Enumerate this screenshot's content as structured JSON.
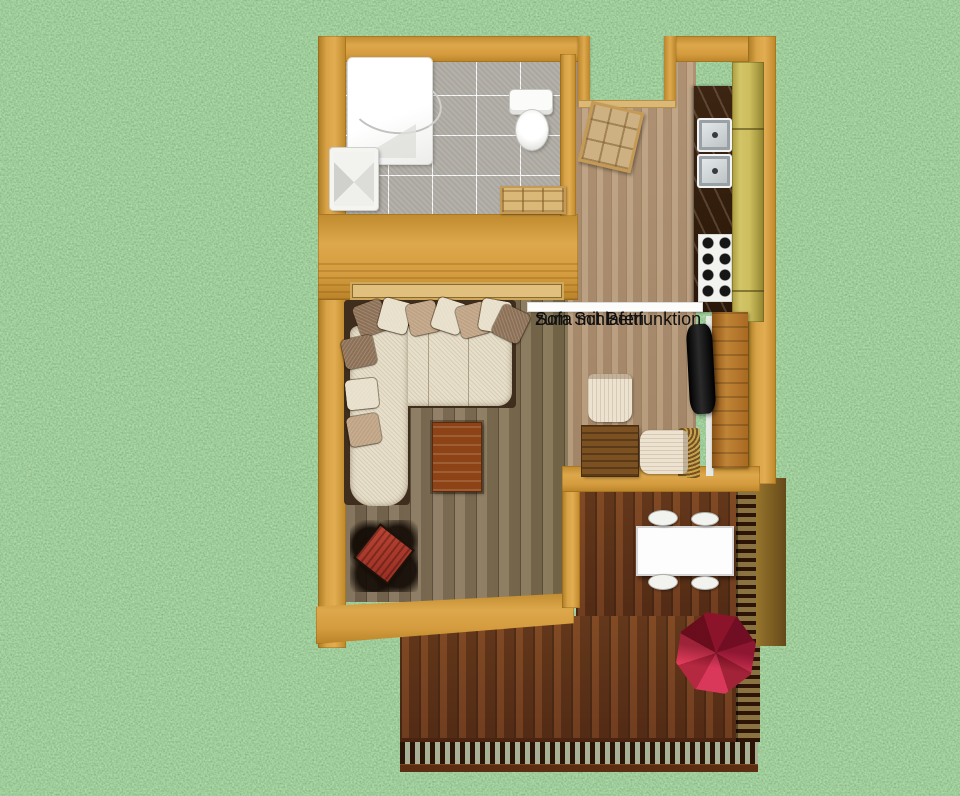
{
  "annotation": {
    "line1": "Sofa mit Bettfunktion",
    "line2": "zum Schlafen",
    "full_text": "Sofa mit Bettfunktion zum Schlafen"
  },
  "scene": {
    "description": "3D top-down floor plan of a small cabin standing on grass",
    "rooms": [
      {
        "name": "bathroom",
        "objects": [
          "shower",
          "wash-basin",
          "toilet",
          "tile-floor",
          "bathroom-door"
        ]
      },
      {
        "name": "entry-hall",
        "objects": [
          "entry-door",
          "door-opening",
          "light-wood-floor"
        ]
      },
      {
        "name": "kitchen",
        "objects": [
          "dark-countertop",
          "sink",
          "second-sink",
          "cooktop",
          "tall-cabinets"
        ]
      },
      {
        "name": "living-room",
        "objects": [
          "corner-sofa-with-pillows",
          "coffee-table",
          "wood-stove",
          "tv",
          "tv-sideboard",
          "window-sill",
          "small-table-with-two-chairs"
        ]
      },
      {
        "name": "deck",
        "objects": [
          "dining-table",
          "four-chairs",
          "red-parasol",
          "balustrade-railing",
          "slat-railing"
        ]
      }
    ]
  },
  "colors": {
    "grass": "#5f9e53",
    "wall": "#d8a246",
    "living_floor": "#84735a",
    "hall_floor": "#b79a7a",
    "deck_floor": "#6d3b1e",
    "tile_floor": "#b5b1aa",
    "cabinet": "#cdbf5e",
    "counter": "#33200f",
    "sofa": "#e7dfca",
    "parasol_red": "#c01c3c",
    "annotation_bg": "#fcfcfa",
    "annotation_text": "#111111"
  }
}
